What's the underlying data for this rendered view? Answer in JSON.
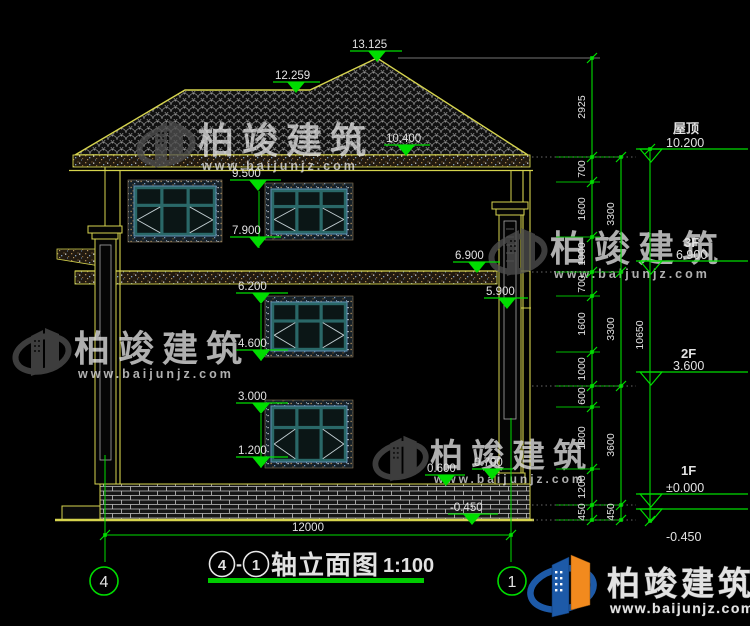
{
  "drawing": {
    "title": {
      "axis_left": "4",
      "separator": "-",
      "axis_right": "1",
      "name": "轴立面图",
      "scale": "1:100"
    },
    "axes": {
      "left": "4",
      "right": "1"
    },
    "floor_levels": [
      {
        "label": "屋顶",
        "value": "10.200"
      },
      {
        "label": "3F",
        "value": "6.900"
      },
      {
        "label": "2F",
        "value": "3.600"
      },
      {
        "label": "1F",
        "value": "±0.000"
      },
      {
        "label": "",
        "value": "-0.450"
      }
    ],
    "spot_elevations": {
      "roof_peak": "13.125",
      "roof_ridge": "12.259",
      "eave": "10.400",
      "w3_head": "9.500",
      "w3_sill": "7.900",
      "slab_top": "6.900",
      "w2_head": "6.200",
      "porch_soffit": "5.900",
      "w2_sill": "4.600",
      "w1_head": "3.000",
      "w1_sill": "1.200",
      "plinth_left": "0.600",
      "plinth_right": "0.700",
      "ground": "-0.450"
    },
    "dimensions": {
      "inner_chain": [
        "2925",
        "700",
        "1600",
        "1000",
        "700",
        "1600",
        "1000",
        "600",
        "1800",
        "1200",
        "450"
      ],
      "mid_chain": [
        "3300",
        "3300",
        "3600",
        "450"
      ],
      "total_height": "10650",
      "total_width": "12000"
    }
  },
  "watermark": {
    "brand": "柏竣建筑",
    "url": "www.baijunjz.com"
  },
  "logo": {
    "brand": "柏竣建筑",
    "url": "www.baijunjz.com"
  },
  "colors": {
    "green": "#00dd00",
    "yellow": "#d6d44e",
    "teal": "#2f6f6f",
    "white": "#e2e2e2",
    "logo_blue": "#1d5aa8",
    "logo_orange": "#f28a1e"
  }
}
